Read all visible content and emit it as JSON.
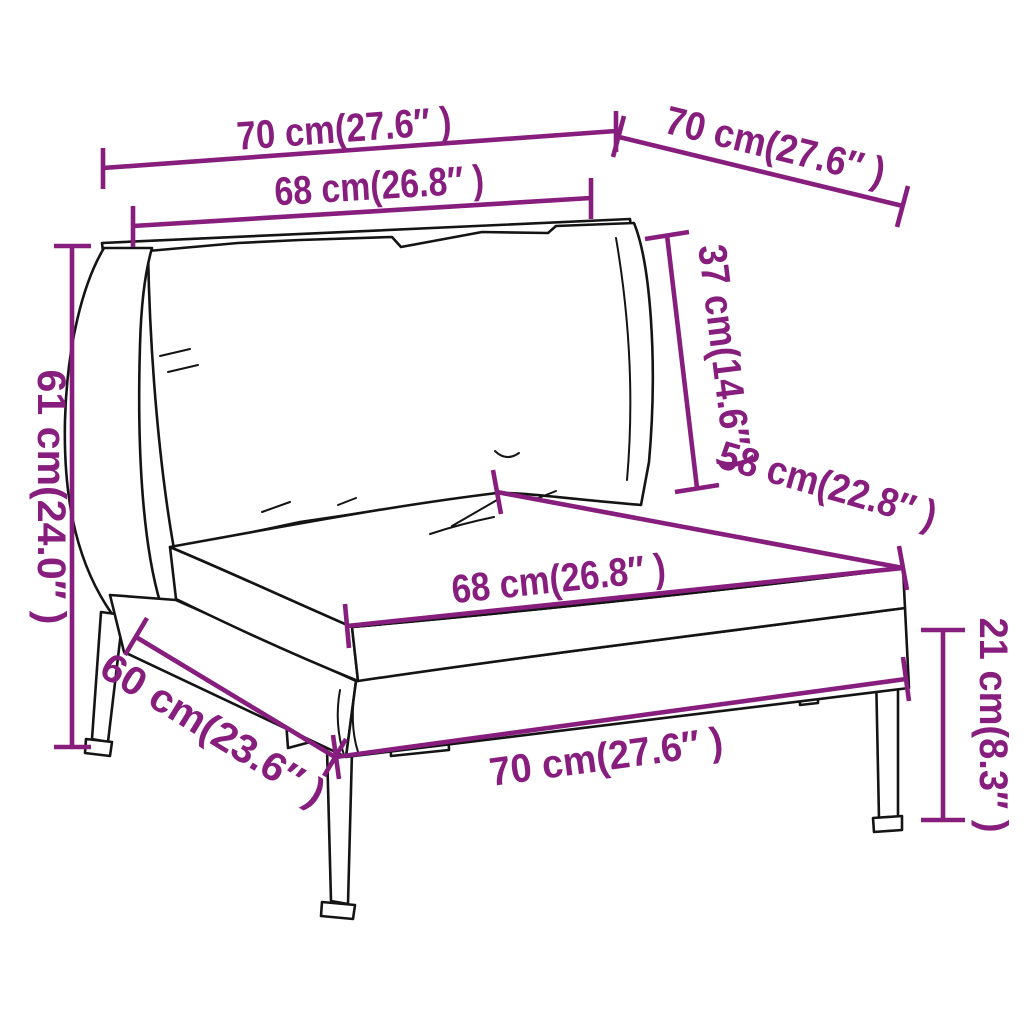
{
  "diagram": {
    "subject": "rattan garden sofa middle section with back cushion and seat cushion - product dimension drawing",
    "background_color": "#ffffff",
    "dimension_color": "#871e7e",
    "line_art_color": "#141414",
    "cushion_color": "#ffffff",
    "dimensions": [
      {
        "id": "back-top-width",
        "label": "70 cm(27.6″ )",
        "cm": 70,
        "inch": 27.6
      },
      {
        "id": "side-top-width",
        "label": "70 cm(27.6″ )",
        "cm": 70,
        "inch": 27.6
      },
      {
        "id": "back-cushion-width",
        "label": "68 cm(26.8″ )",
        "cm": 68,
        "inch": 26.8
      },
      {
        "id": "back-cushion-height",
        "label": "37 cm(14.6″ )",
        "cm": 37,
        "inch": 14.6
      },
      {
        "id": "seat-depth",
        "label": "58 cm(22.8″ )",
        "cm": 58,
        "inch": 22.8
      },
      {
        "id": "total-height",
        "label": "61 cm(24.0″ )",
        "cm": 61,
        "inch": 24.0
      },
      {
        "id": "seat-cushion-width",
        "label": "68 cm(26.8″ )",
        "cm": 68,
        "inch": 26.8
      },
      {
        "id": "base-depth",
        "label": "60 cm(23.6″ )",
        "cm": 60,
        "inch": 23.6
      },
      {
        "id": "front-width",
        "label": "70 cm(27.6″ )",
        "cm": 70,
        "inch": 27.6
      },
      {
        "id": "leg-height",
        "label": "21 cm(8.3″ )",
        "cm": 21,
        "inch": 8.3
      }
    ]
  }
}
